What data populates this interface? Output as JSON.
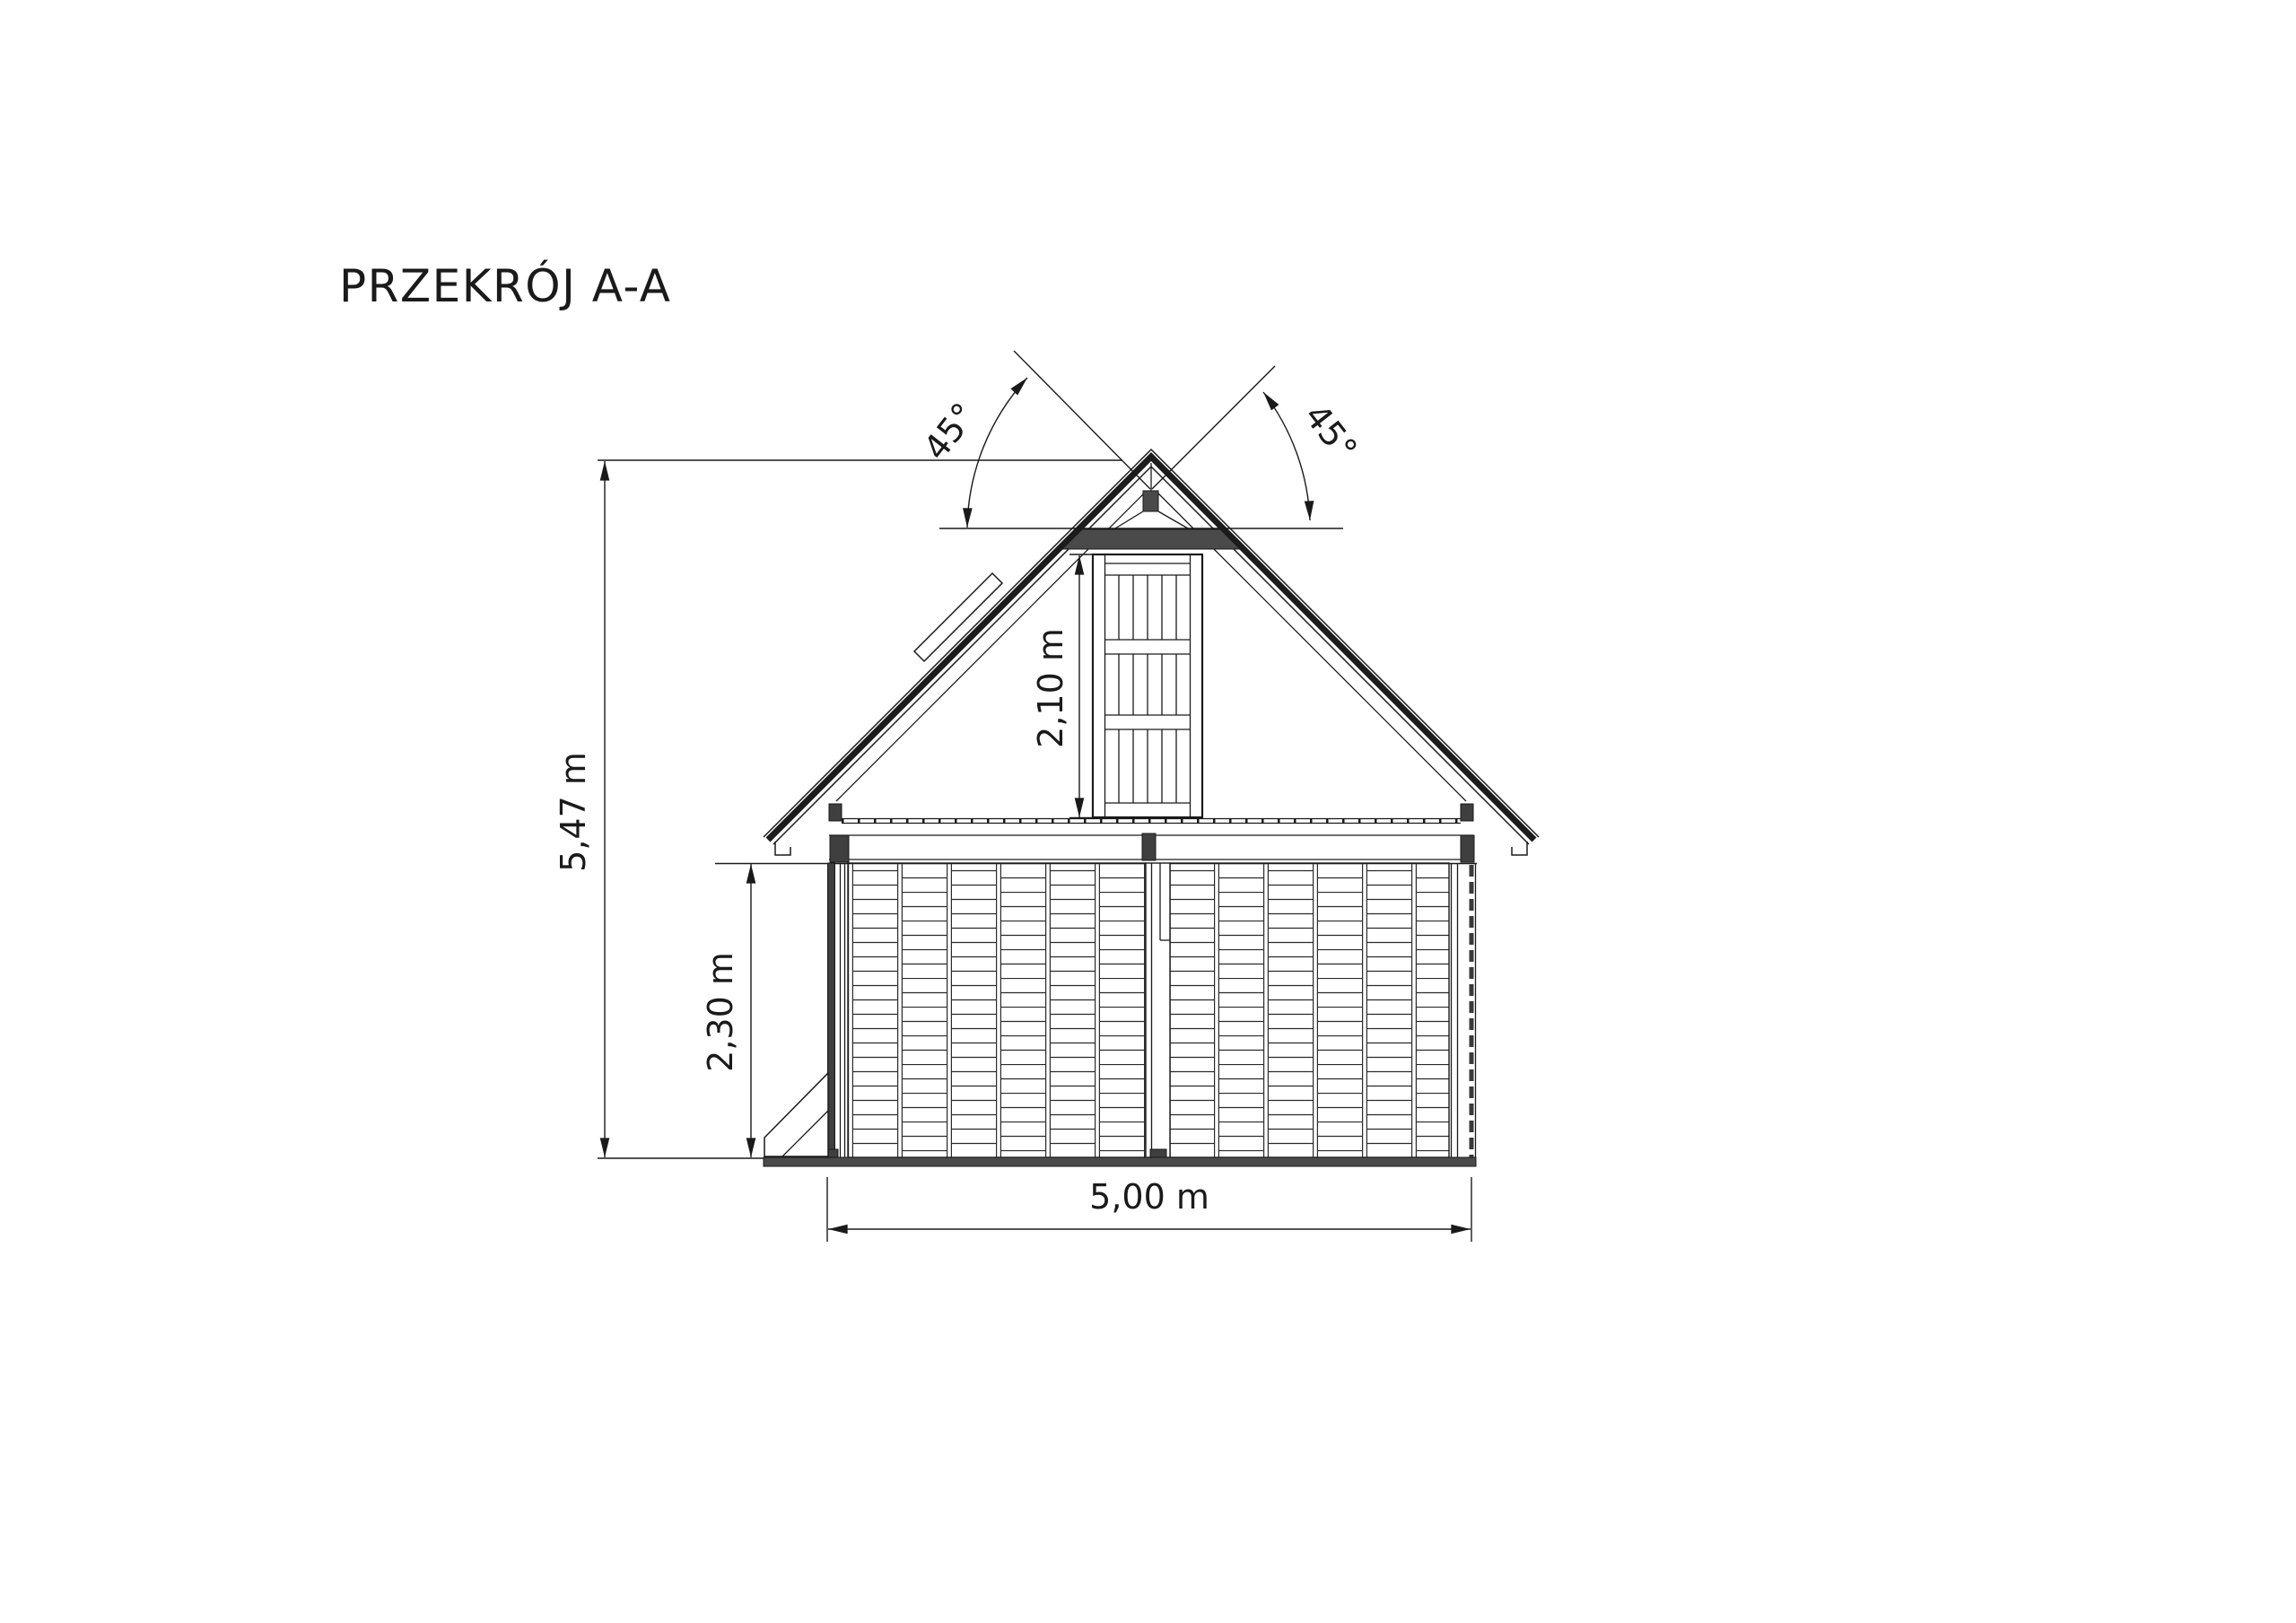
{
  "title": "PRZEKRÓJ A-A",
  "drawing": {
    "type": "architectural-section",
    "dimensions": {
      "total_height": "5,47 m",
      "ground_floor_height": "2,30 m",
      "attic_door_height": "2,10 m",
      "building_width": "5,00 m",
      "roof_angle_left": "45°",
      "roof_angle_right": "45°"
    },
    "colors": {
      "line": "#1a1a1a",
      "dark_fill": "#4a4a4a",
      "background": "#ffffff"
    }
  }
}
